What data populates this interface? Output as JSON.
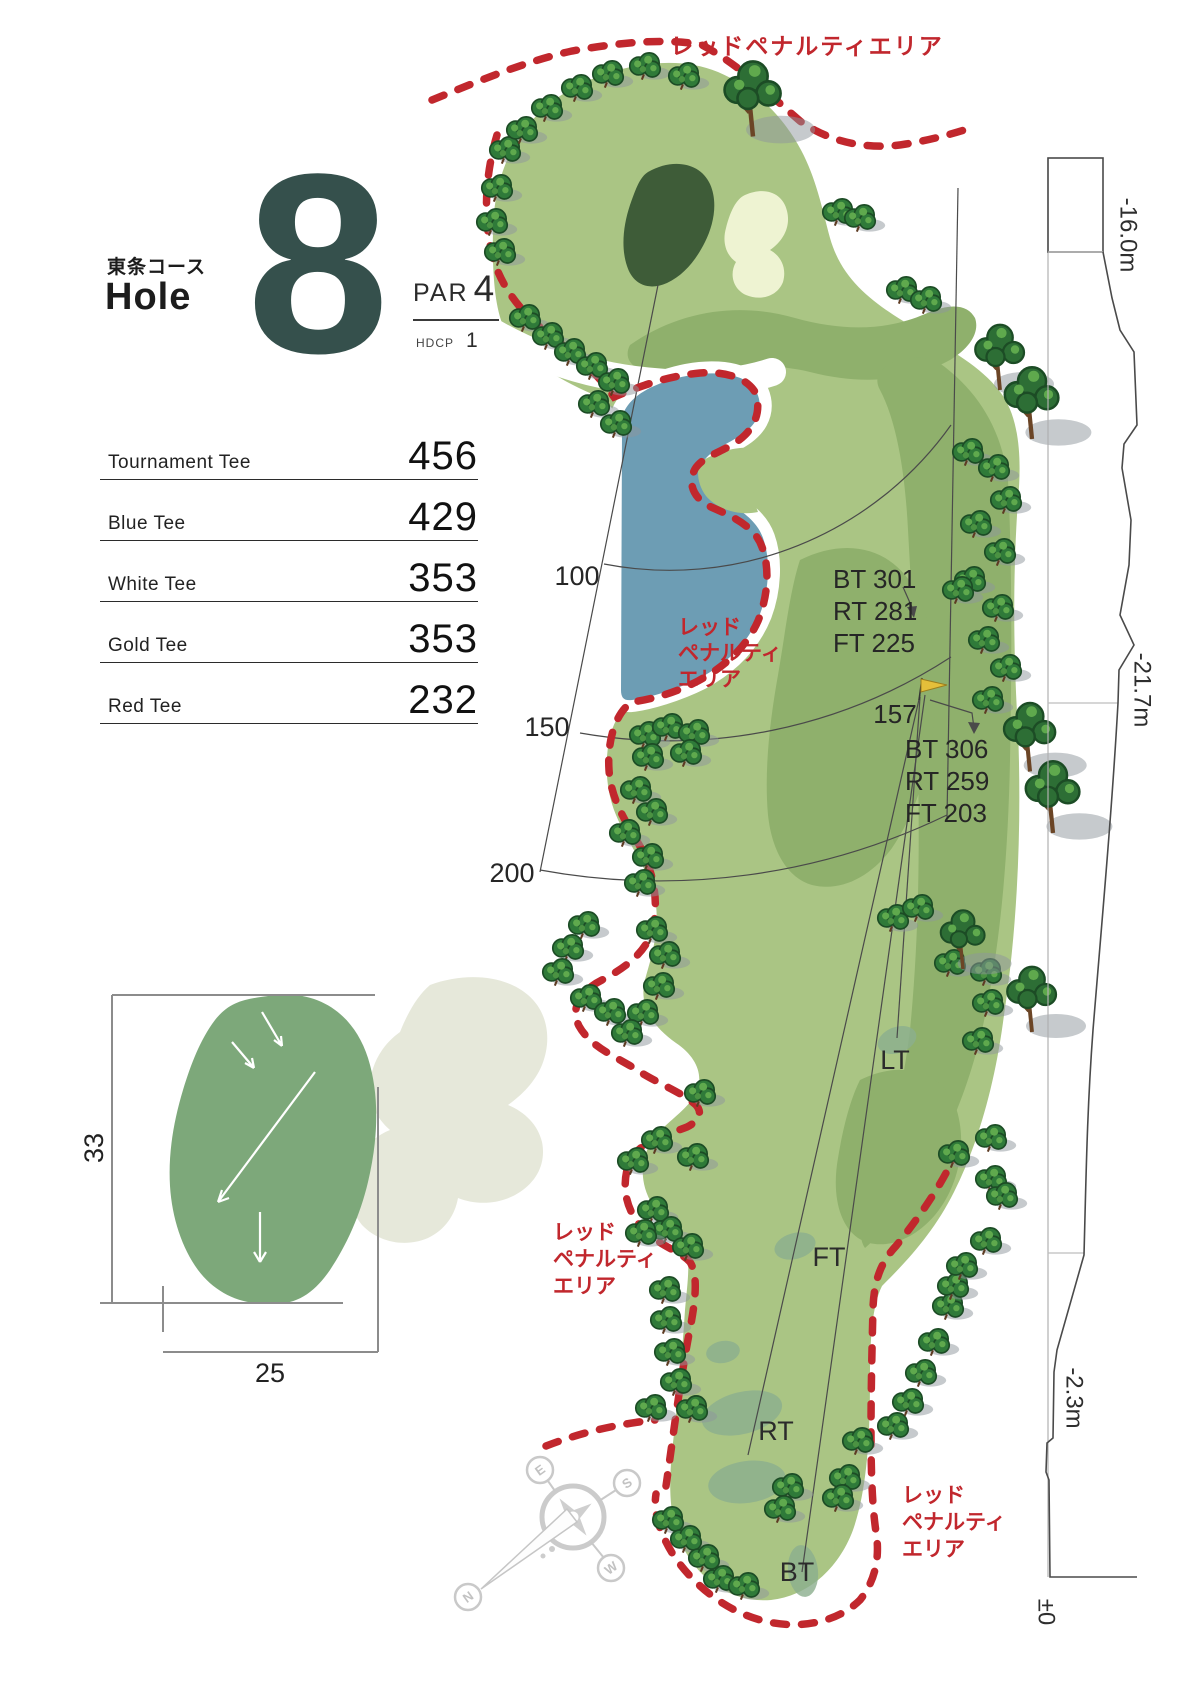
{
  "header": {
    "course": "東条コース",
    "hole_label": "Hole",
    "hole_number": "8",
    "par_label": "PAR",
    "par_value": "4",
    "hdcp_label": "HDCP",
    "hdcp_value": "1"
  },
  "tees": {
    "rows": [
      {
        "name": "Tournament Tee",
        "yards": "456"
      },
      {
        "name": "Blue Tee",
        "yards": "429"
      },
      {
        "name": "White Tee",
        "yards": "353"
      },
      {
        "name": "Gold Tee",
        "yards": "353"
      },
      {
        "name": "Red Tee",
        "yards": "232"
      }
    ]
  },
  "penalty": {
    "top": "レッドペナルティエリア",
    "water": [
      "レッド",
      "ペナルティ",
      "エリア"
    ],
    "left": [
      "レッド",
      "ペナルティ",
      "エリア"
    ],
    "bottom": [
      "レッド",
      "ペナルティ",
      "エリア"
    ]
  },
  "distance_arcs": {
    "d100": "100",
    "d150": "150",
    "d200": "200"
  },
  "annotations": {
    "group1": [
      "BT 301",
      "RT 281",
      "FT 225"
    ],
    "mid_distance": "157",
    "group2": [
      "BT 306",
      "RT 259",
      "FT 203"
    ]
  },
  "tee_markers": {
    "lt": "LT",
    "ft": "FT",
    "rt": "RT",
    "bt": "BT"
  },
  "elevation": {
    "top": "-16.0m",
    "middle": "-21.7m",
    "lower": "-2.3m",
    "base": "±0"
  },
  "green_inset": {
    "depth": "33",
    "width": "25"
  },
  "compass": {
    "n": "N",
    "e": "E",
    "s": "S",
    "w": "W"
  },
  "colors": {
    "penalty_red": "#c1272d",
    "fairway_green": "#aac584",
    "rough_green": "#8fb06c",
    "putting_green_dark": "#3e5c38",
    "water_blue": "#6d9db4",
    "bunker_cream": "#eef3d2",
    "inset_green": "#7da87a",
    "hole_number_teal": "#35504c"
  }
}
